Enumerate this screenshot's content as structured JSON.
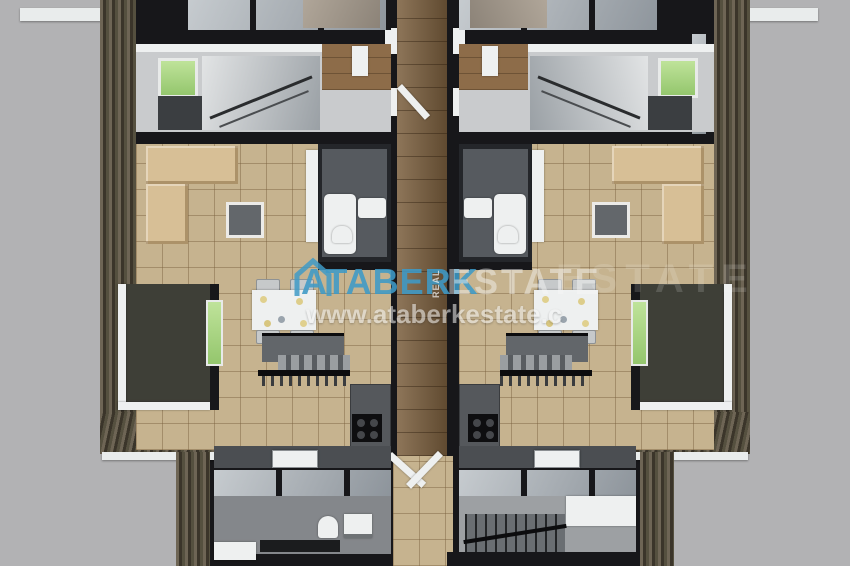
{
  "scene": {
    "type": "3d-floor-plan-render",
    "description": "Top-down 3D render of two mirrored apartment units separated by a central wood-floored corridor"
  },
  "watermark": {
    "logo_icon": "house-outline-icon",
    "brand": "ATABERK",
    "brand_small_vertical": "REAL",
    "brand_suffix": "ESTATE",
    "brand_suffix_ghost": "ESTATE",
    "url": "www.ataberkestate.c"
  },
  "colors": {
    "background": "#b2b2b4",
    "interior-wall": "#17171a",
    "exterior-wall": "#4c4536",
    "exterior-wall-stripe": "#6e6555",
    "tile-floor": "#c6b38f",
    "corridor-wood": "#7b5f3e",
    "hall-floor": "#c9cbcd",
    "glass-light": "#b9bec3",
    "glass-dark": "#8d949b",
    "accent-green": "#94c66d",
    "sofa-tan": "#d7bf96",
    "fixture-white": "#eef0f0",
    "counter-gray": "#4b4e52",
    "watermark-blue": "#3e9ac7",
    "watermark-white": "#f8f8f8"
  },
  "plan": {
    "corridor": "central-corridor",
    "units": [
      {
        "side": "left",
        "rooms": [
          "top-room",
          "stair-hall",
          "living-room",
          "bathroom",
          "dining-area",
          "inner-staircase",
          "kitchen",
          "balcony",
          "lower-bathroom"
        ]
      },
      {
        "side": "right",
        "rooms": [
          "top-room",
          "stair-hall",
          "living-room",
          "bathroom",
          "dining-area",
          "inner-staircase",
          "kitchen",
          "balcony",
          "stairwell"
        ]
      }
    ]
  }
}
